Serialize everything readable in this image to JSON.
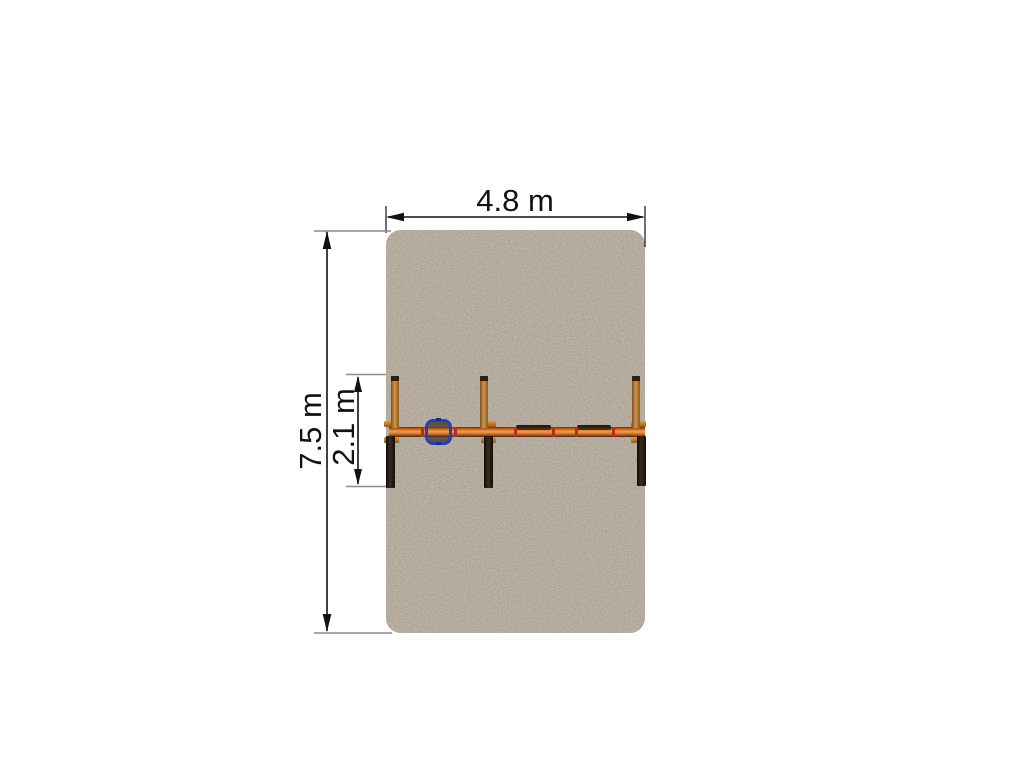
{
  "diagram": {
    "labels": {
      "width": "4.8 m",
      "height": "7.5 m",
      "depth": "2.1 m"
    },
    "colors": {
      "surface_base": "#c2b7a8",
      "surface_speckle": "#61564a",
      "beam_orange": "#d97a2a",
      "post_orange": "#c98c3e",
      "post_dark": "#2a1e12",
      "joint_red": "#b03124",
      "seat_blue": "#2d3eb5",
      "dimension_line": "#111111",
      "extension_line": "#8c8c8c"
    }
  }
}
